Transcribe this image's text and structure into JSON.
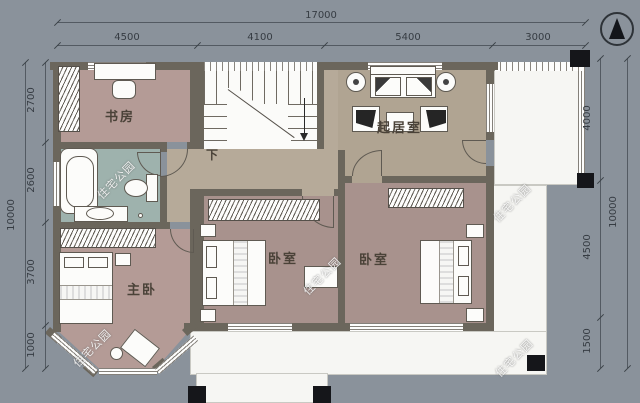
{
  "watermark": "住宅公园",
  "dimensions": {
    "top": {
      "total": "17000",
      "segments": [
        "4500",
        "4100",
        "5400",
        "3000"
      ]
    },
    "left": {
      "total": "10000",
      "segments": [
        "2700",
        "2600",
        "3700",
        "1000"
      ]
    },
    "right": {
      "total": "10000",
      "segments": [
        "4000",
        "4500",
        "1500"
      ]
    }
  },
  "rooms": {
    "study": "书房",
    "master": "主卧",
    "bedroom_mid": "卧室",
    "bedroom_right": "卧室",
    "living": "起居室",
    "stair_down": "下"
  },
  "colors": {
    "background": "#8a929b",
    "wall": "#6b665c",
    "bedroom_floor": "#a8928d",
    "master_floor": "#b49b96",
    "living_floor": "#b0a492",
    "bath_floor": "#9eb2ad",
    "hall_floor": "#b6aa99",
    "terrace": "#f6f6f3",
    "column": "#15161a"
  }
}
